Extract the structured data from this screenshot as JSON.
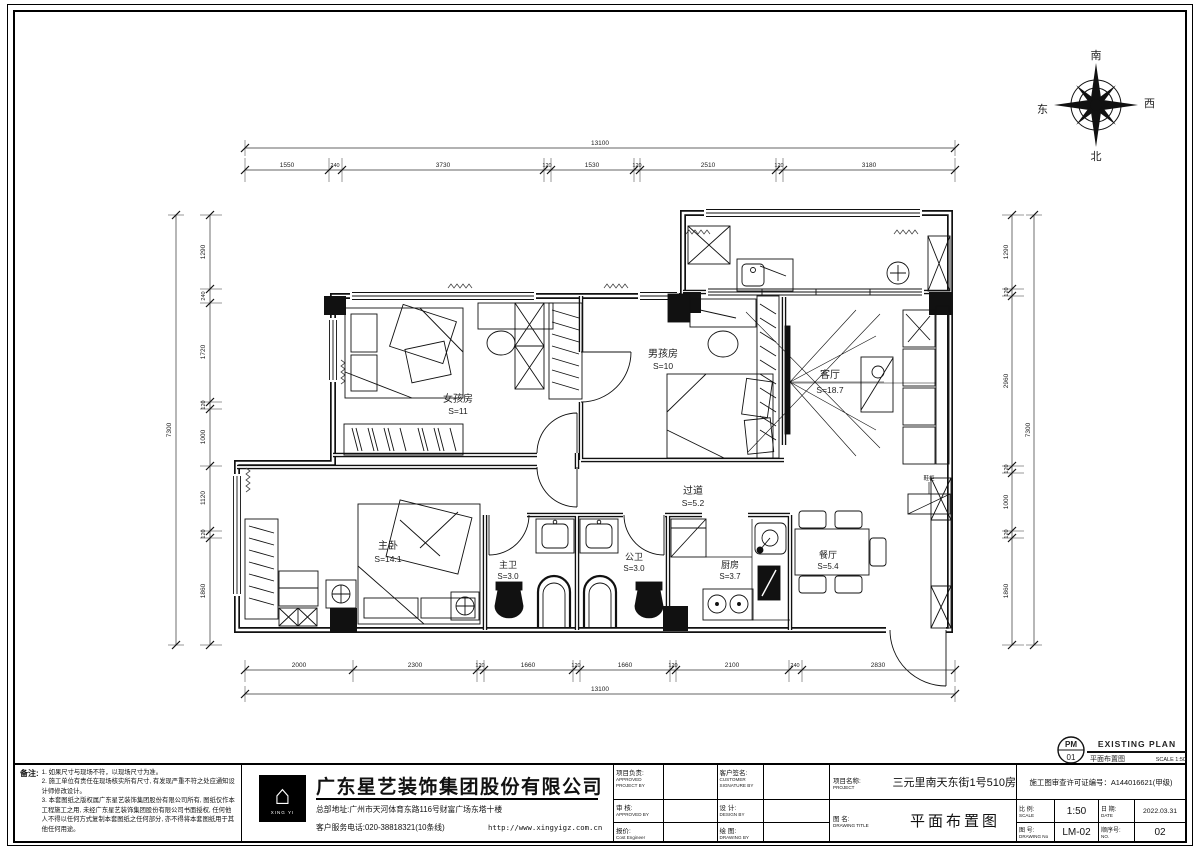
{
  "plan": {
    "rooms": [
      {
        "name": "女孩房",
        "area": "S=11"
      },
      {
        "name": "男孩房",
        "area": "S=10"
      },
      {
        "name": "客厅",
        "area": "S=18.7"
      },
      {
        "name": "过道",
        "area": "S=5.2"
      },
      {
        "name": "主卧",
        "area": "S=14.1"
      },
      {
        "name": "主卫",
        "area": "S=3.0"
      },
      {
        "name": "公卫",
        "area": "S=3.0"
      },
      {
        "name": "厨房",
        "area": "S=3.7"
      },
      {
        "name": "餐厅",
        "area": "S=5.4"
      }
    ],
    "annotations": {
      "shoe_cabinet": "鞋柜"
    },
    "compass": {
      "n": "北",
      "s": "南",
      "e": "东",
      "w": "西"
    },
    "stamp": {
      "code_top": "PM",
      "code_no": "01",
      "title_en": "EXISTING PLAN",
      "title_cn": "平面布置图",
      "scale": "SCALE 1:50"
    },
    "dims": {
      "top_total": "13100",
      "top": [
        "1550",
        "240",
        "3730",
        "120",
        "1530",
        "120",
        "2510",
        "120",
        "3180"
      ],
      "bottom": [
        "2000",
        "2300",
        "120",
        "1660",
        "120",
        "1660",
        "120",
        "2100",
        "240",
        "2830"
      ],
      "bottom_total": "13100",
      "left": [
        "1290",
        "240",
        "1720",
        "120",
        "1000",
        "1120",
        "120",
        "1860"
      ],
      "left_total": "7300",
      "right": [
        "1290",
        "120",
        "2960",
        "120",
        "1000",
        "120",
        "1860"
      ],
      "right_total": "7300"
    }
  },
  "titleblock": {
    "notes_label": "备注:",
    "notes": [
      "1. 如果尺寸与现场不符，以现场尺寸为准。",
      "2. 施工单位有责任在现场核实所有尺寸, 有发现严重不符之处应通知设计师修改设计。",
      "3. 本套图纸之版权属广东星艺装饰集团股份有限公司所有, 图纸仅作本工程施工之用, 未经广东星艺装饰集团股份有限公司书面授权, 任何他人不得以任何方式复制本套图纸之任何部分, 亦不得将本套图纸用于其他任何用途。"
    ],
    "company": {
      "logo_glyph": "⌂",
      "logo_text": "XING YI",
      "name": "广东星艺装饰集团股份有限公司",
      "address": "总部地址:广州市天河体育东路116号财富广场东塔十楼",
      "phone": "客户服务电话:020-38818321(10条线)",
      "website": "http://www.xingyigz.com.cn"
    },
    "cells": {
      "pm_cn": "项目负责:",
      "pm_en": "APPROVED PROJECT BY",
      "audit_cn": "审 核:",
      "audit_en": "APPROVED BY",
      "cost_cn": "报价:",
      "cost_en": "Cost Engineer",
      "customer_cn": "客户签名:",
      "customer_en": "CUSTOMER SIGNATURE BY",
      "design_cn": "设 计:",
      "design_en": "DESIGN BY",
      "draw_cn": "绘 图:",
      "draw_en": "DRAWING BY"
    },
    "project": {
      "label_cn": "项目名称:",
      "label_en": "PROJECT",
      "value": "三元里南天东街1号510房"
    },
    "drawing": {
      "label_cn": "图 名:",
      "label_en": "DRAWING TITLE",
      "value": "平面布置图"
    },
    "permit": "施工图审查许可证编号：A144016621(甲级)",
    "scale": {
      "label_cn": "比 例:",
      "label_en": "SCALE",
      "value": "1:50"
    },
    "date": {
      "label_cn": "日 期:",
      "label_en": "DATE",
      "value": "2022.03.31"
    },
    "dwg_no": {
      "label_cn": "图 号:",
      "label_en": "DRAWING No",
      "value": "LM-02"
    },
    "seq_no": {
      "label_cn": "顺序号:",
      "label_en": "NO.",
      "value": "02"
    }
  }
}
